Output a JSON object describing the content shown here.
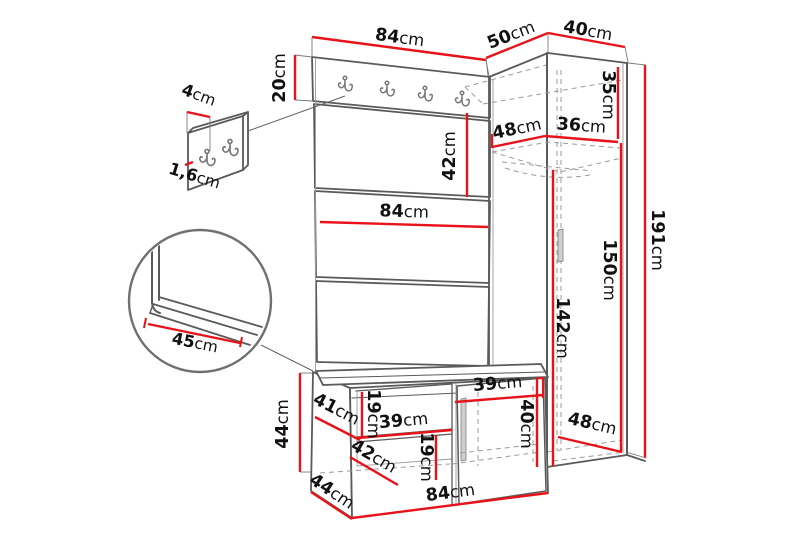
{
  "diagram": {
    "kind": "furniture-dimension-drawing",
    "unit": "cm",
    "colors": {
      "dimension_red": "#e8131a",
      "outline_gray": "#5a5a5a",
      "outline_light": "#9a9a9a",
      "dashed_gray": "#9b9b9b",
      "text_black": "#111111",
      "background": "#ffffff"
    },
    "labels": {
      "panel_top_width": "84cm",
      "corner_top_left": "50cm",
      "corner_top_right": "40cm",
      "hook_board_height": "20cm",
      "detail_hook_offset": "4cm",
      "detail_panel_thickness": "1,6cm",
      "panel_section_height": "42cm",
      "panel_mid_width": "84cm",
      "corner_inner_left": "48cm",
      "wardrobe_inner_width": "36cm",
      "wardrobe_top_section_height": "35cm",
      "wardrobe_inner_height": "150cm",
      "wardrobe_left_inner_height": "142cm",
      "wardrobe_total_height": "191cm",
      "seat_depth_detail": "45cm",
      "bench_height": "44cm",
      "bench_side_diagonal": "41cm",
      "bench_opening_height": "19cm",
      "bench_left_opening_width": "39cm",
      "bench_lower_shelf_diagonal": "42cm",
      "bench_lower_opening_height": "19cm",
      "bench_right_opening_width": "39cm",
      "bench_door_height": "40cm",
      "wardrobe_bottom_depth": "48cm",
      "bench_bottom_width": "84cm",
      "bench_bottom_depth": "44cm"
    }
  }
}
